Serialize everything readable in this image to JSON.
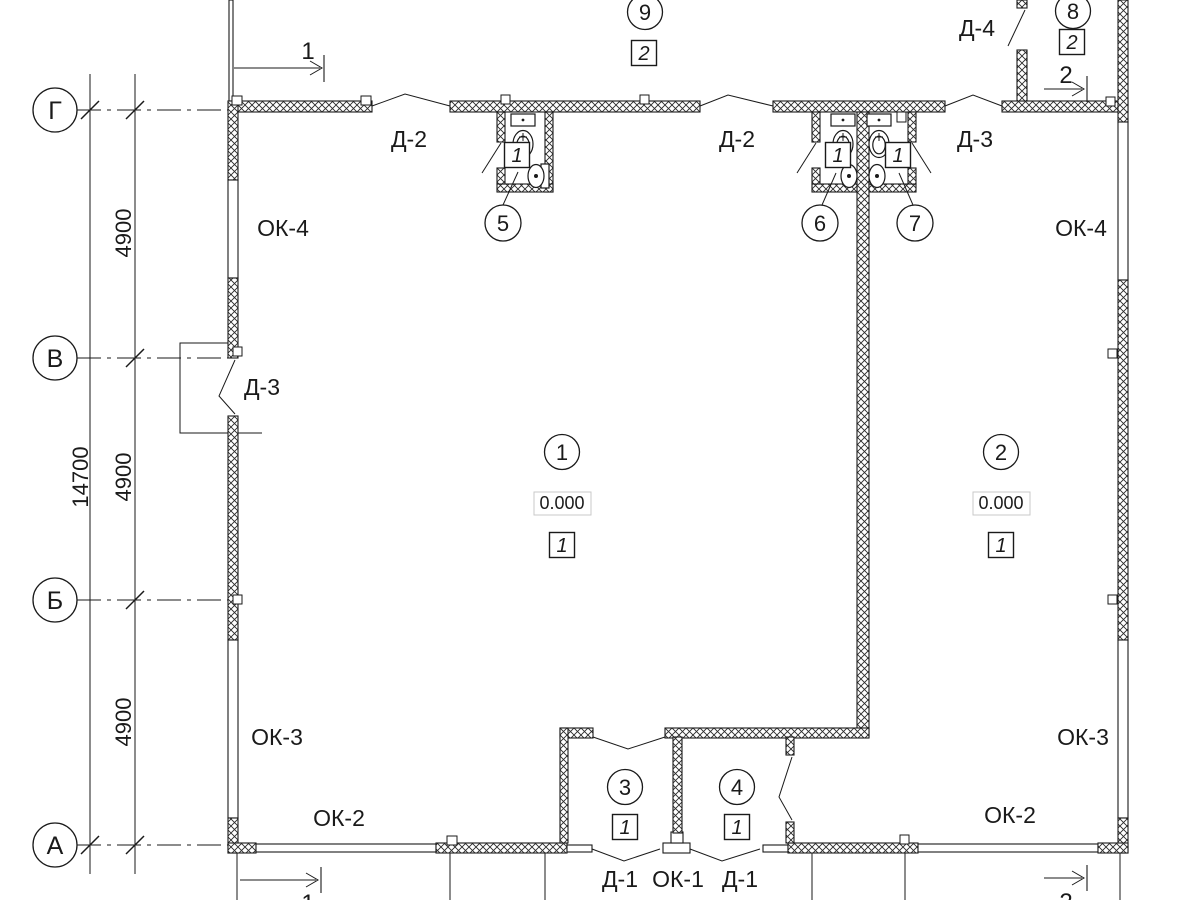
{
  "axes": {
    "row_g": "Г",
    "row_v": "В",
    "row_b": "Б",
    "row_a": "А"
  },
  "dimensions": {
    "span_gv": "4900",
    "span_vb": "4900",
    "span_ba": "4900",
    "total": "14700"
  },
  "sections": {
    "s1": "1",
    "s2": "2"
  },
  "rooms": {
    "r1": {
      "num": "1",
      "elev": "0.000",
      "finish": "1"
    },
    "r2": {
      "num": "2",
      "elev": "0.000",
      "finish": "1"
    },
    "r3": {
      "num": "3",
      "finish": "1"
    },
    "r4": {
      "num": "4",
      "finish": "1"
    },
    "r5": {
      "num": "5",
      "finish": "1"
    },
    "r6": {
      "num": "6",
      "finish": "1"
    },
    "r7": {
      "num": "7",
      "finish": "1"
    },
    "r8": {
      "num": "8",
      "finish": "2"
    },
    "r9": {
      "num": "9",
      "finish": "2"
    }
  },
  "openings": {
    "door_d1": "Д-1",
    "door_d2": "Д-2",
    "door_d3": "Д-3",
    "door_d4": "Д-4",
    "window_ok1": "ОК-1",
    "window_ok2": "ОК-2",
    "window_ok3": "ОК-3",
    "window_ok4": "ОК-4"
  },
  "colors": {
    "line": "#1a1a1a",
    "background": "#ffffff"
  }
}
